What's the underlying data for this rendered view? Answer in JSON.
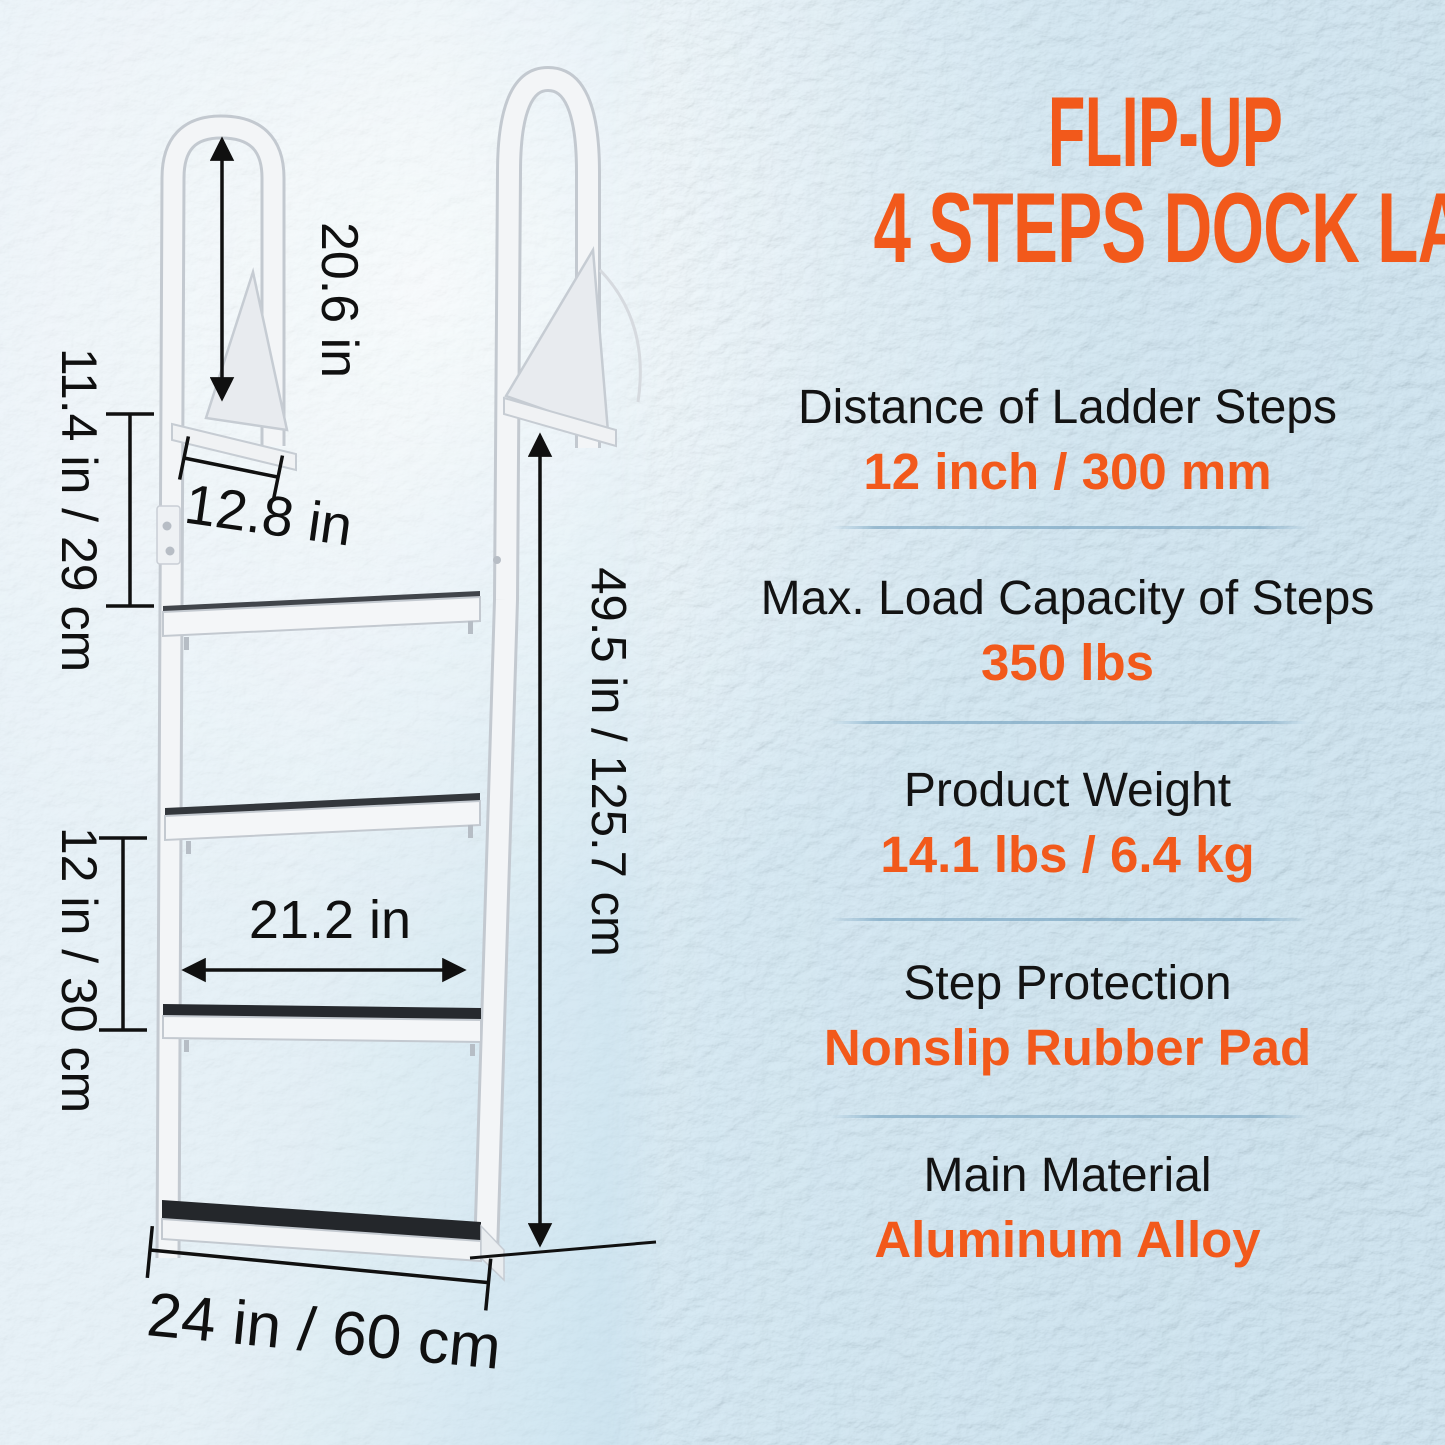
{
  "header": {
    "title_line1": "FLIP-UP",
    "title_line2": "4 STEPS DOCK LADDER"
  },
  "specs": [
    {
      "label": "Distance of Ladder Steps",
      "value": "12 inch / 300 mm"
    },
    {
      "label": "Max. Load Capacity of Steps",
      "value": "350 lbs"
    },
    {
      "label": "Product Weight",
      "value": "14.1 lbs / 6.4 kg"
    },
    {
      "label": "Step Protection",
      "value": "Nonslip Rubber Pad"
    },
    {
      "label": "Main Material",
      "value": "Aluminum Alloy"
    }
  ],
  "diagram": {
    "product": "flip-up 4 steps dock ladder line drawing with dimension arrows",
    "dimensions": {
      "hoop_height": "20.6 in",
      "upper_rail_section": "11.4 in / 29 cm",
      "mount_plate_width": "12.8 in",
      "step_spacing": "12 in / 30 cm",
      "step_width": "21.2 in",
      "ladder_length": "49.5 in / 125.7 cm",
      "overall_width": "24 in / 60 cm"
    }
  },
  "colors": {
    "accent_orange": "#f2591b",
    "dimension_text_black": "#101010",
    "background_light_blue": "#dcedf6",
    "background_texture_blue": "#b4d6e8",
    "ladder_metal_white": "#f3f5f7",
    "step_rubber_pad_black": "#26292e"
  }
}
